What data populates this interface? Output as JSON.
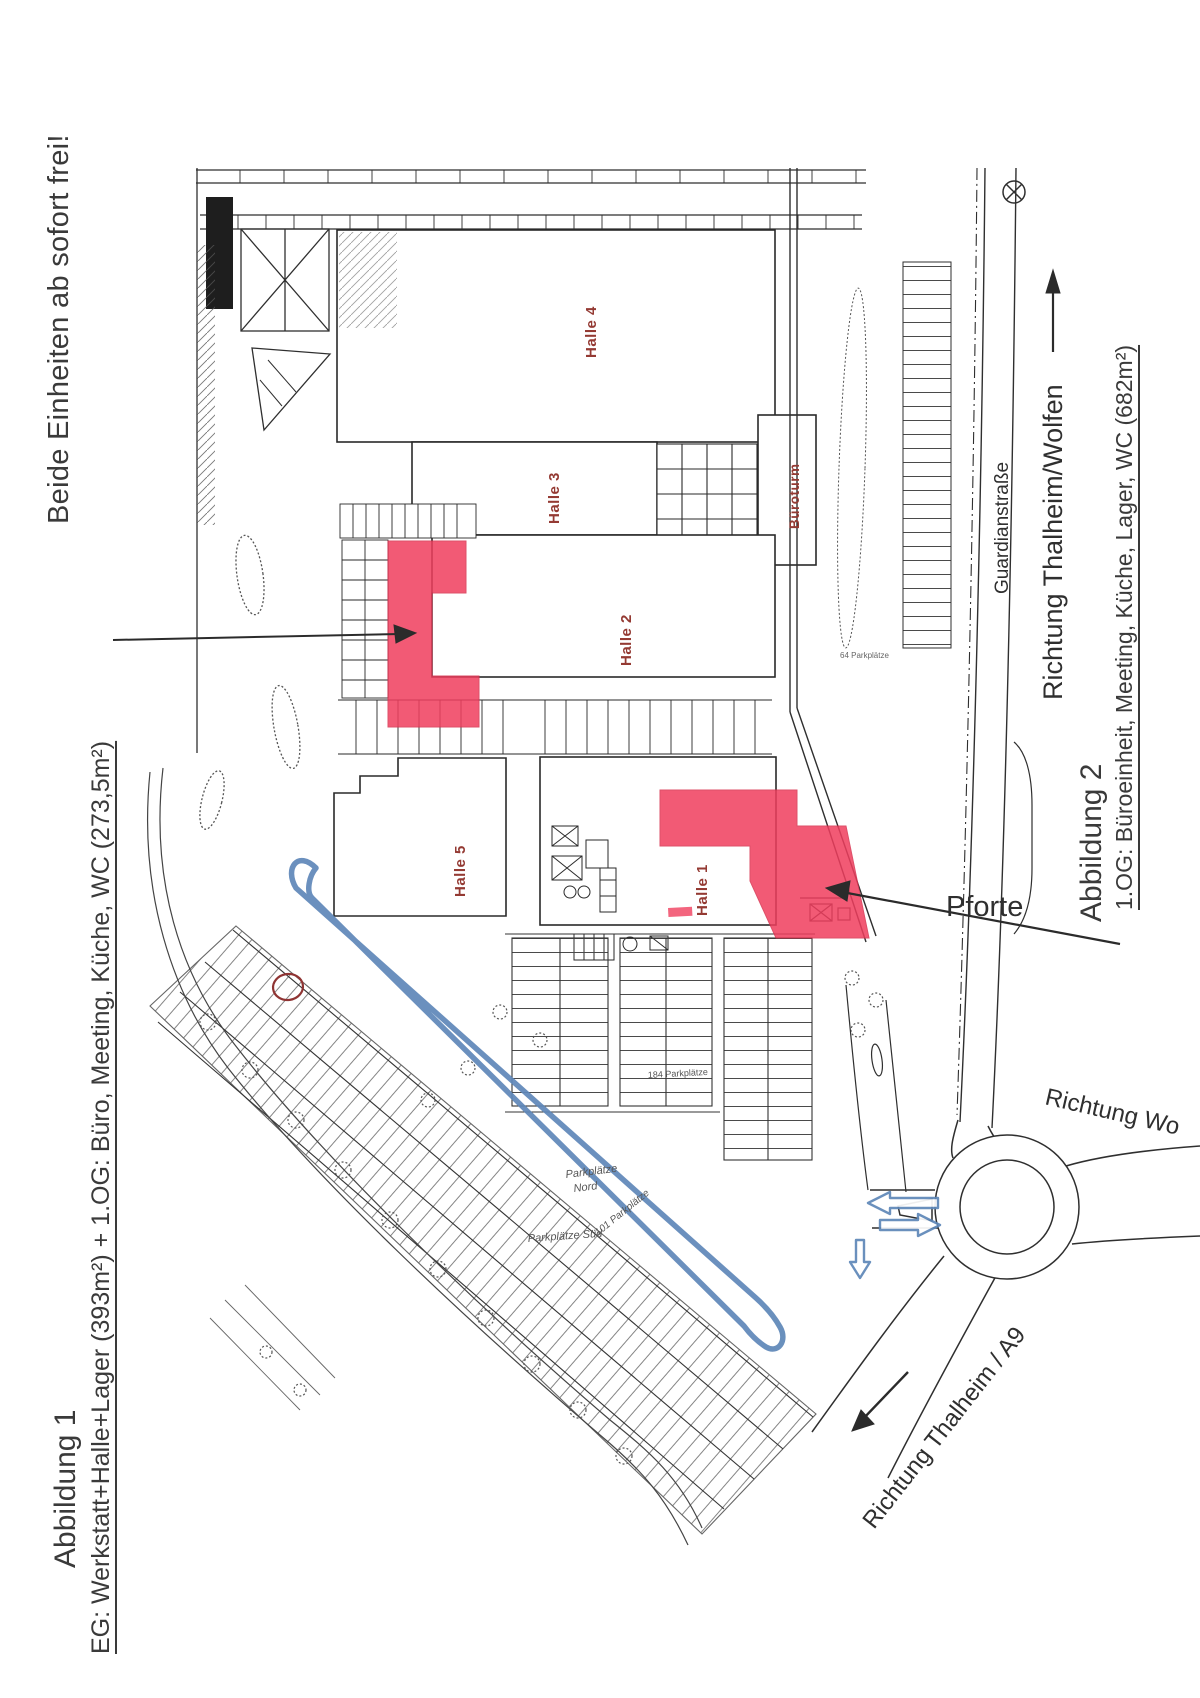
{
  "headline": "Beide Einheiten ab sofort frei!",
  "captions": {
    "fig1_title": "Abbildung 1",
    "fig1_line": "EG: Werkstatt+Halle+Lager (393m²) + 1.OG: Büro, Meeting, Küche, WC (273,5m²)",
    "fig2_title": "Abbildung 2",
    "fig2_line": "1.OG: Büroeinheit, Meeting, Küche, Lager, WC (682m²)"
  },
  "plan": {
    "halls": {
      "halle1": "Halle 1",
      "halle2": "Halle 2",
      "halle3": "Halle 3",
      "halle4": "Halle 4",
      "halle5": "Halle 5",
      "bueroturm": "Büroturm"
    },
    "gate": "Pforte",
    "streets": {
      "guardianstrasse": "Guardianstraße",
      "richtung_thalheim_wolfen": "Richtung Thalheim/Wolfen",
      "richtung_wolfen": "Richtung Wo",
      "richtung_thalheim_a9": "Richtung Thalheim / A9"
    },
    "parking": {
      "p64": "64 Parkplätze",
      "p184": "184 Parkplätze",
      "nord_line1": "Parkplätze",
      "nord_line2": "Nord",
      "sued": "Parkplätze Süd",
      "p101": "101 Parkplätze"
    },
    "colors": {
      "highlight": "#f03e5e",
      "route_blue": "#5e87b8",
      "hall_label_red": "#943a33",
      "ink": "#2f2f2f"
    }
  }
}
